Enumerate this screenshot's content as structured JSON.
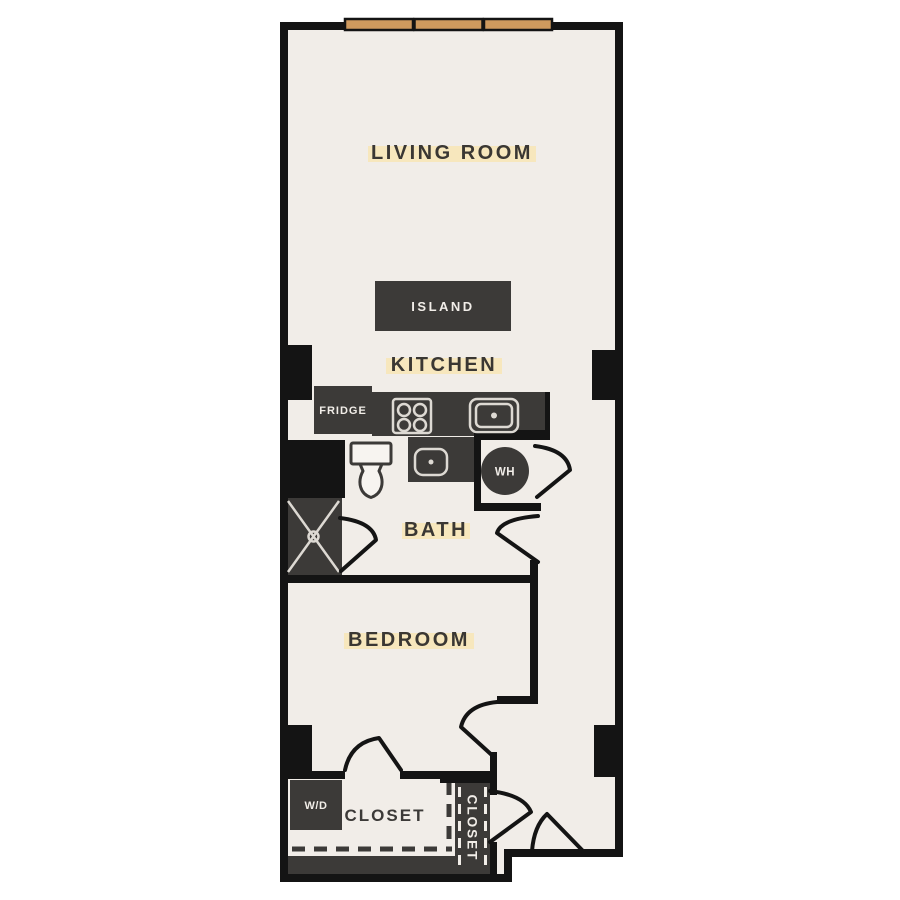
{
  "floor_plan": {
    "labels": {
      "living_room": "LIVING ROOM",
      "kitchen": "KITCHEN",
      "bath": "BATH",
      "bedroom": "BEDROOM",
      "island": "ISLAND",
      "fridge": "FRIDGE",
      "washer_dryer": "W/D",
      "water_heater": "WH",
      "closet_main": "CLOSET",
      "closet_entry": "CLOSET"
    },
    "icons": {
      "stove": "4-burner-cooktop",
      "kitchen_sink": "single-basin-sink",
      "bath_sink": "vanity-sink",
      "toilet": "toilet",
      "shower": "shower-stall-x",
      "windows": "3-pane-window-strip",
      "doors": "door-swing"
    },
    "colors": {
      "canvas": "#ffffff",
      "floor": "#f1ede8",
      "wall": "#141414",
      "fixture": "#3c3a38",
      "window": "#cf9a5e",
      "label_text": "#3a3733",
      "label_highlight": "#f7e7bd",
      "fixture_line": "#ddd9d3",
      "toilet_fill": "#f7f4f0"
    }
  }
}
